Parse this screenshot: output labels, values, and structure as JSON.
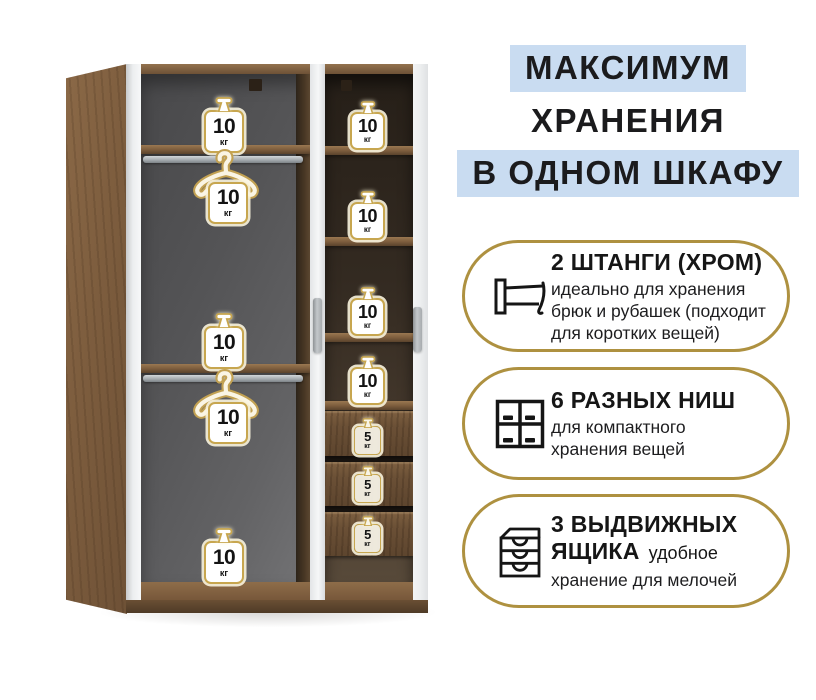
{
  "header": {
    "line1": "МАКСИМУМ",
    "line2": "ХРАНЕНИЯ",
    "line3": "В ОДНОМ ШКАФУ"
  },
  "features": [
    {
      "icon": "clothes-rail-icon",
      "title": "2 ШТАНГИ (ХРОМ)",
      "desc_lines": [
        "идеально для хранения",
        "брюк и рубашек (подходит",
        "для коротких вещей)"
      ]
    },
    {
      "icon": "wardrobe-niches-icon",
      "title": "6 РАЗНЫХ НИШ",
      "desc_lines": [
        "для компактного",
        "хранения вещей"
      ]
    },
    {
      "icon": "drawer-unit-icon",
      "title_line1": "3 ВЫДВИЖНЫХ",
      "title_line2": "ЯЩИКА",
      "desc_inline": "удобное",
      "desc_lines": [
        "хранение для мелочей"
      ]
    }
  ],
  "wardrobe": {
    "left_section_labels": [
      {
        "type": "weight",
        "value": "10",
        "unit": "кг"
      },
      {
        "type": "hanger-weight",
        "value": "10",
        "unit": "кг"
      },
      {
        "type": "weight",
        "value": "10",
        "unit": "кг"
      },
      {
        "type": "hanger-weight",
        "value": "10",
        "unit": "кг"
      },
      {
        "type": "weight",
        "value": "10",
        "unit": "кг"
      }
    ],
    "right_section_shelf_labels": [
      {
        "value": "10",
        "unit": "кг"
      },
      {
        "value": "10",
        "unit": "кг"
      },
      {
        "value": "10",
        "unit": "кг"
      },
      {
        "value": "10",
        "unit": "кг"
      }
    ],
    "right_section_drawer_labels": [
      {
        "value": "5",
        "unit": "кг"
      },
      {
        "value": "5",
        "unit": "кг"
      },
      {
        "value": "5",
        "unit": "кг"
      }
    ]
  },
  "colors": {
    "highlight_blue": "#c9dcf1",
    "badge_border_gold": "#ae9140",
    "label_border_gold": "#c7a64f",
    "wood_brown": "#7b5b3c",
    "interior_grey": "#5a5a5c"
  }
}
